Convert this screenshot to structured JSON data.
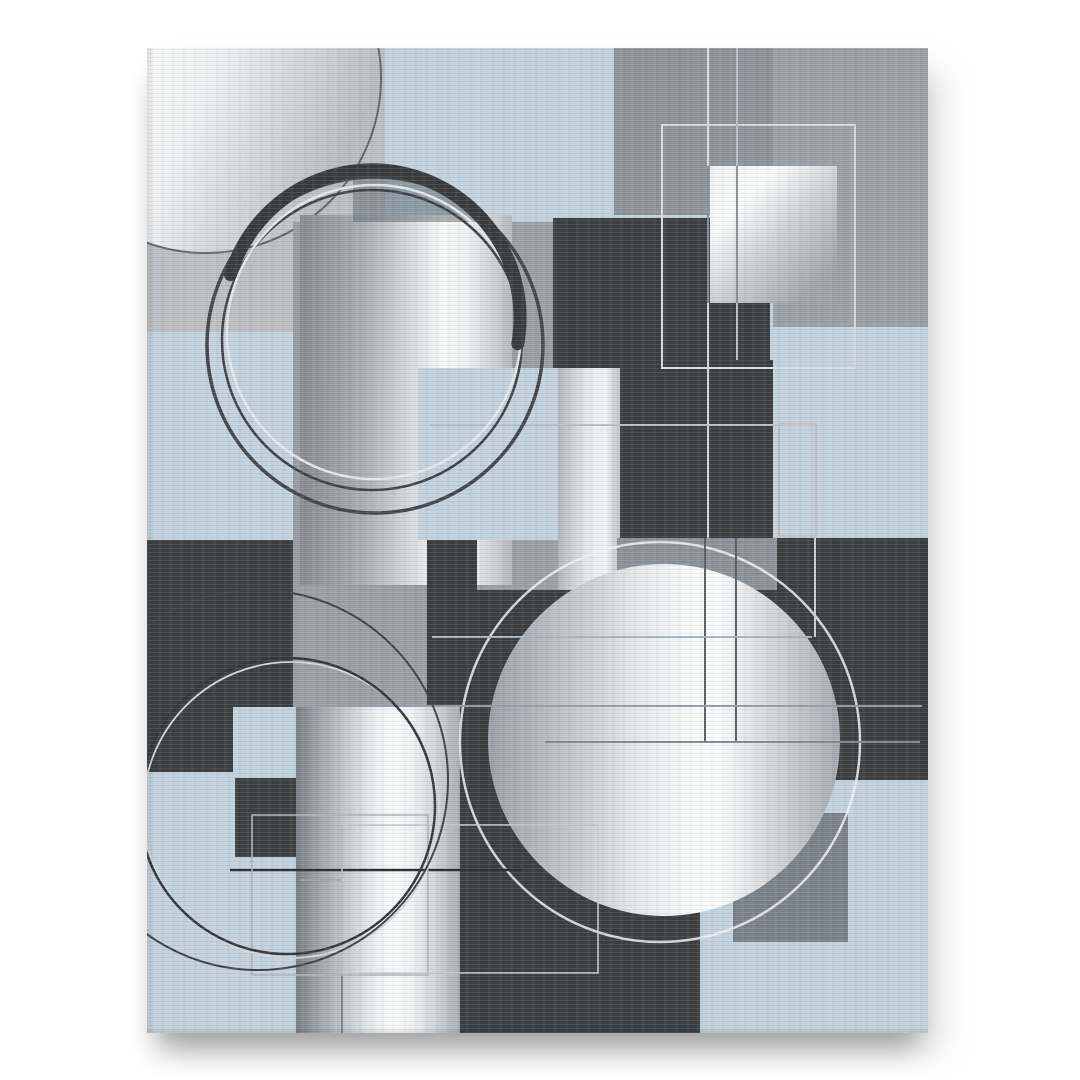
{
  "scene": {
    "background": "#ffffff",
    "canvas": {
      "x": 147,
      "y": 48,
      "w": 781,
      "h": 985
    },
    "style": "abstract-geometric-canvas-print"
  },
  "palette": {
    "blue": "#c3d2dc",
    "charcoal": "#3b3f42",
    "light_gray": "#bcc0c4",
    "mid_gray": "#9aa0a6",
    "column_gray": "#8d949a",
    "band_gray": "#8b9298",
    "inner_square_gray": "#7b838a",
    "silver_high": "#fbfcfc",
    "silver_low": "#868c92"
  },
  "artwork": {
    "gradients": [
      {
        "id": "gTL",
        "x1": 0,
        "y1": 0.05,
        "x2": 1,
        "y2": 0.5,
        "stops": [
          [
            0,
            "#cfd3d6"
          ],
          [
            0.25,
            "#eaeced"
          ],
          [
            0.45,
            "#f7f8f8"
          ],
          [
            0.6,
            "#eef0f1"
          ],
          [
            0.8,
            "#d2d6d9"
          ],
          [
            1,
            "#b7bcc1"
          ]
        ]
      },
      {
        "id": "gH",
        "x1": 0,
        "y1": 0,
        "x2": 1,
        "y2": 0,
        "stops": [
          [
            0,
            "#868c92"
          ],
          [
            0.3,
            "#a8afb5"
          ],
          [
            0.55,
            "#dde1e3"
          ],
          [
            0.68,
            "#f8f9f9"
          ],
          [
            0.8,
            "#eef0f1"
          ],
          [
            1,
            "#b5bac0"
          ]
        ]
      },
      {
        "id": "gB7b",
        "x1": 0,
        "y1": 0,
        "x2": 1,
        "y2": 0,
        "stops": [
          [
            0,
            "#b4b9be"
          ],
          [
            0.45,
            "#e4e7e9"
          ],
          [
            0.75,
            "#f2f4f5"
          ],
          [
            1,
            "#c0c5c9"
          ]
        ]
      },
      {
        "id": "gCR",
        "x1": 0,
        "y1": 0,
        "x2": 1,
        "y2": 0,
        "stops": [
          [
            0,
            "#9ba2a8"
          ],
          [
            0.18,
            "#b8bec3"
          ],
          [
            0.4,
            "#e2e5e7"
          ],
          [
            0.55,
            "#f7f8f8"
          ],
          [
            0.65,
            "#fbfcfc"
          ],
          [
            0.78,
            "#dbdee1"
          ],
          [
            1,
            "#a4abb1"
          ]
        ]
      },
      {
        "id": "gCol",
        "x1": 0,
        "y1": 0,
        "x2": 1,
        "y2": 0,
        "stops": [
          [
            0,
            "#767d83"
          ],
          [
            0.12,
            "#99a0a6"
          ],
          [
            0.3,
            "#c4c9cd"
          ],
          [
            0.47,
            "#eaedee"
          ],
          [
            0.6,
            "#fafbfb"
          ],
          [
            0.73,
            "#edeff0"
          ],
          [
            0.87,
            "#cbd0d4"
          ],
          [
            1,
            "#a7adb3"
          ]
        ]
      },
      {
        "id": "gS2",
        "x1": 0,
        "y1": 0,
        "x2": 0.85,
        "y2": 0.9,
        "stops": [
          [
            0,
            "#f0f2f3"
          ],
          [
            0.3,
            "#fafbfb"
          ],
          [
            0.6,
            "#ced2d5"
          ],
          [
            1,
            "#9da4aa"
          ]
        ]
      }
    ],
    "shapes": [
      {
        "t": "rect",
        "x": 0,
        "y": 0,
        "w": 781,
        "h": 985,
        "f": "#c3d2dc",
        "n": "base-blue-field"
      },
      {
        "t": "rect",
        "x": 0,
        "y": 0,
        "w": 238,
        "h": 284,
        "f": "#bcc0c4",
        "n": "top-left-gray-block"
      },
      {
        "t": "rect",
        "x": 467,
        "y": 0,
        "w": 159,
        "h": 167,
        "f": "#8d949a",
        "n": "top-gray-column"
      },
      {
        "t": "rect",
        "x": 626,
        "y": 0,
        "w": 155,
        "h": 279,
        "f": "#9aa1a7",
        "n": "top-right-gray-block"
      },
      {
        "t": "circle",
        "cx": 59,
        "cy": 30,
        "r": 175,
        "f": "url:gTL",
        "s": "#60666b",
        "sw": 2,
        "n": "silver-circle-top-left"
      },
      {
        "t": "rect",
        "x": 146,
        "y": 174,
        "w": 267,
        "h": 485,
        "f": "#9aa0a6",
        "n": "center-gray-square"
      },
      {
        "t": "rect",
        "x": 406,
        "y": 170,
        "w": 217,
        "h": 202,
        "f": "#3b3f42",
        "n": "charcoal-square-top"
      },
      {
        "t": "rect",
        "x": 473,
        "y": 312,
        "w": 157,
        "h": 178,
        "f": "#3b3f42",
        "n": "charcoal-column-mid"
      },
      {
        "t": "rect",
        "x": 153,
        "y": 167,
        "w": 212,
        "h": 370,
        "f": "url:gH",
        "n": "silver-rect-center"
      },
      {
        "t": "rect",
        "x": 411,
        "y": 320,
        "w": 62,
        "h": 272,
        "f": "url:gB7b",
        "n": "silver-band-mid"
      },
      {
        "t": "rect",
        "x": 271,
        "y": 320,
        "w": 140,
        "h": 172,
        "f": "#c3d2dc",
        "n": "blue-square-mid"
      },
      {
        "t": "rect",
        "x": 470,
        "y": 490,
        "w": 160,
        "h": 52,
        "f": "#8b9298",
        "n": "gray-band-center"
      },
      {
        "t": "rect",
        "x": 626,
        "y": 279,
        "w": 155,
        "h": 211,
        "f": "#c3d2dc",
        "n": "blue-band-right"
      },
      {
        "t": "rect",
        "x": 630,
        "y": 490,
        "w": 151,
        "h": 244,
        "f": "#3b3f42",
        "n": "charcoal-right-block"
      },
      {
        "t": "rect",
        "x": 330,
        "y": 542,
        "w": 300,
        "h": 192,
        "f": "#3b3f42",
        "n": "charcoal-center-block"
      },
      {
        "t": "rect",
        "x": 280,
        "y": 492,
        "w": 50,
        "h": 288,
        "f": "#3b3f42",
        "n": "charcoal-strip"
      },
      {
        "t": "rect",
        "x": 0,
        "y": 492,
        "w": 146,
        "h": 232,
        "f": "#3b3f42",
        "n": "charcoal-left-block"
      },
      {
        "t": "rect",
        "x": 86,
        "y": 659,
        "w": 62,
        "h": 68,
        "f": "#c3d2dc",
        "n": "small-blue-square"
      },
      {
        "t": "rect",
        "x": 88,
        "y": 730,
        "w": 62,
        "h": 79,
        "f": "#3b3f42",
        "n": "small-charcoal-square"
      },
      {
        "t": "rect",
        "x": 149,
        "y": 659,
        "w": 164,
        "h": 326,
        "f": "url:gCol",
        "n": "silver-column-bottom"
      },
      {
        "t": "rect",
        "x": 313,
        "y": 727,
        "w": 240,
        "h": 258,
        "f": "#3b3f42",
        "n": "charcoal-bottom-block"
      },
      {
        "t": "rect",
        "x": 553,
        "y": 732,
        "w": 228,
        "h": 253,
        "f": "#c3d2dc",
        "n": "blue-square-bottom-right"
      },
      {
        "t": "rect",
        "x": 586,
        "y": 765,
        "w": 115,
        "h": 129,
        "f": "#7b838a",
        "n": "gray-inner-square"
      },
      {
        "t": "seg",
        "cx": 225,
        "cy": 270,
        "r": 148,
        "f": "rgba(90,100,108,0.5)",
        "clip": [
          206,
          110,
          169,
          64
        ],
        "n": "gray-ring-segment"
      },
      {
        "t": "circle",
        "cx": 517,
        "cy": 692,
        "r": 176,
        "f": "url:gCR",
        "n": "silver-circle-center-right"
      },
      {
        "t": "circle",
        "cx": 513,
        "cy": 694,
        "r": 200,
        "s": "rgba(240,243,244,0.85)",
        "sw": 2.5,
        "n": "white-ring-center-right"
      },
      {
        "t": "orect",
        "x": 515,
        "y": 77,
        "w": 193,
        "h": 243,
        "s": "#d9dee1",
        "sw": 2,
        "n": "outline-square-top-right"
      },
      {
        "t": "rect",
        "x": 563,
        "y": 118,
        "w": 127,
        "h": 137,
        "f": "url:gS2",
        "n": "silver-square-top-right"
      },
      {
        "t": "orect",
        "x": 632,
        "y": 376,
        "w": 37,
        "h": 112,
        "s": "rgba(196,178,175,0.85)",
        "sw": 1.5,
        "n": "outline-rect-rose"
      },
      {
        "t": "line",
        "x1": 561,
        "y1": 0,
        "x2": 561,
        "y2": 118,
        "s": "#d8dde0",
        "sw": 2,
        "n": "vertical-line-a1"
      },
      {
        "t": "line",
        "x1": 561,
        "y1": 118,
        "x2": 561,
        "y2": 255,
        "s": "#878d93",
        "sw": 2,
        "n": "vertical-line-a2"
      },
      {
        "t": "line",
        "x1": 561,
        "y1": 255,
        "x2": 561,
        "y2": 490,
        "s": "#cfd6da",
        "sw": 2,
        "n": "vertical-line-a3"
      },
      {
        "t": "line",
        "x1": 590,
        "y1": 0,
        "x2": 590,
        "y2": 118,
        "s": "#b9c2c8",
        "sw": 2,
        "n": "vertical-line-b1"
      },
      {
        "t": "line",
        "x1": 590,
        "y1": 118,
        "x2": 590,
        "y2": 255,
        "s": "#8a9096",
        "sw": 2,
        "n": "vertical-line-b2"
      },
      {
        "t": "line",
        "x1": 590,
        "y1": 255,
        "x2": 590,
        "y2": 312,
        "s": "#b9c2c8",
        "sw": 2,
        "n": "vertical-line-b3"
      },
      {
        "t": "line",
        "x1": 558,
        "y1": 490,
        "x2": 558,
        "y2": 694,
        "s": "#5a6168",
        "sw": 2,
        "n": "vertical-line-dark-a"
      },
      {
        "t": "line",
        "x1": 589,
        "y1": 490,
        "x2": 589,
        "y2": 694,
        "s": "#5a6168",
        "sw": 2,
        "n": "vertical-line-dark-b"
      },
      {
        "t": "line",
        "x1": 668,
        "y1": 490,
        "x2": 668,
        "y2": 589,
        "s": "#ccd3d7",
        "sw": 2,
        "n": "vertical-line-silver-right"
      },
      {
        "t": "line",
        "x1": 283,
        "y1": 377,
        "x2": 630,
        "y2": 377,
        "s": "#b5c3cc",
        "sw": 2,
        "n": "horizontal-line-1"
      },
      {
        "t": "line",
        "x1": 285,
        "y1": 589,
        "x2": 665,
        "y2": 589,
        "s": "#aab7c0",
        "sw": 2,
        "n": "horizontal-line-2"
      },
      {
        "t": "line",
        "x1": 146,
        "y1": 658,
        "x2": 775,
        "y2": 658,
        "s": "#98a3ab",
        "sw": 2,
        "n": "horizontal-line-3"
      },
      {
        "t": "line",
        "x1": 398,
        "y1": 694,
        "x2": 773,
        "y2": 694,
        "s": "#858f97",
        "sw": 2,
        "n": "horizontal-line-4"
      },
      {
        "t": "line",
        "x1": 83,
        "y1": 822,
        "x2": 375,
        "y2": 822,
        "s": "#2e3235",
        "sw": 2.5,
        "n": "horizontal-line-dark"
      },
      {
        "t": "line",
        "x1": 195,
        "y1": 777,
        "x2": 195,
        "y2": 985,
        "s": "#6a7076",
        "sw": 1.5,
        "n": "vertical-line-bottom"
      },
      {
        "t": "line",
        "x1": 153,
        "y1": 832,
        "x2": 196,
        "y2": 832,
        "s": "#9aa1a7",
        "sw": 1.5,
        "n": "horizontal-line-small"
      },
      {
        "t": "orect",
        "x": 105,
        "y": 767,
        "w": 176,
        "h": 160,
        "s": "rgba(174,182,187,0.8)",
        "sw": 2,
        "n": "outline-square-bottom-1"
      },
      {
        "t": "orect",
        "x": 195,
        "y": 777,
        "w": 256,
        "h": 148,
        "s": "rgba(195,202,207,0.8)",
        "sw": 2,
        "n": "outline-square-bottom-2"
      },
      {
        "t": "circle",
        "cx": 144,
        "cy": 762,
        "r": 148,
        "s": "#d5dadd",
        "sw": 1.8,
        "n": "ring-bottom-silver-echo"
      },
      {
        "t": "circle",
        "cx": 140,
        "cy": 758,
        "r": 148,
        "s": "#34383b",
        "sw": 2.5,
        "n": "ring-bottom-dark"
      },
      {
        "t": "circle",
        "cx": 111,
        "cy": 732,
        "r": 190,
        "s": "#3f4448",
        "sw": 2,
        "n": "ring-bottom-outer-arc"
      },
      {
        "t": "circle",
        "cx": 225,
        "cy": 292,
        "r": 150,
        "s": "#3f4347",
        "sw": 2.5,
        "n": "ring-top-inner-dark"
      },
      {
        "t": "circle",
        "cx": 227,
        "cy": 284,
        "r": 147,
        "s": "#e4e8ea",
        "sw": 2.5,
        "n": "ring-top-silver"
      },
      {
        "t": "circle",
        "cx": 228,
        "cy": 297,
        "r": 168,
        "s": "#44484c",
        "sw": 3.5,
        "n": "ring-top-outer-dark"
      },
      {
        "t": "arc",
        "cx": 225,
        "cy": 270,
        "r": 148,
        "a1": 163,
        "a2": -10,
        "s": "#383c3f",
        "sw": 13,
        "n": "ring-top-thick-arc"
      }
    ]
  }
}
